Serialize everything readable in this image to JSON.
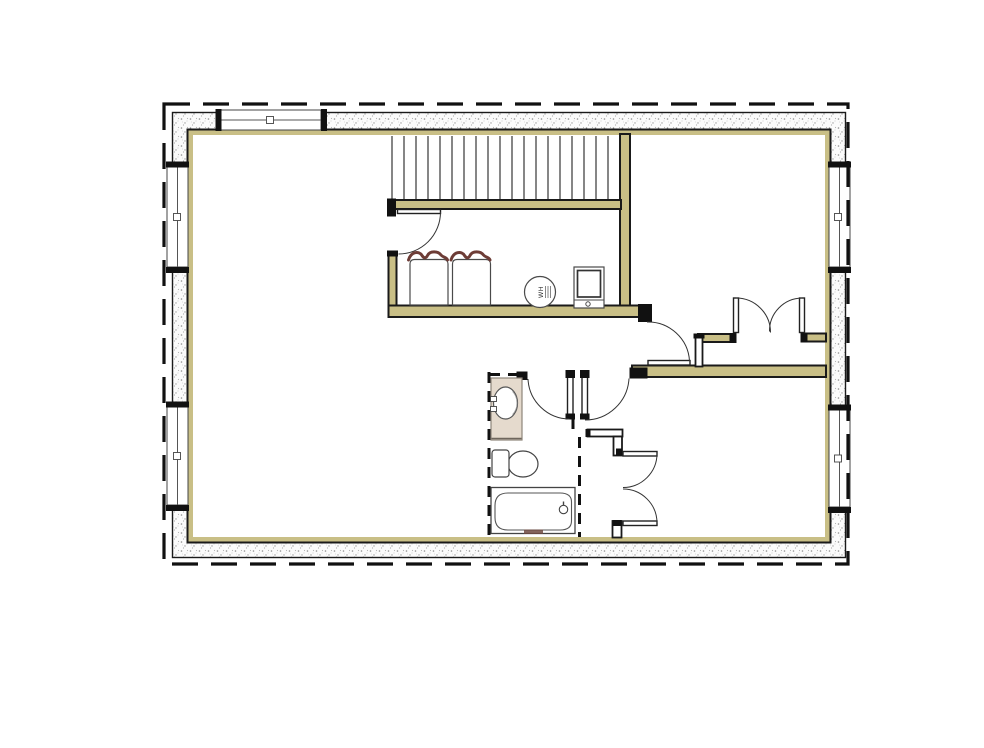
{
  "labels": {
    "water_heater": "WH"
  },
  "colors": {
    "paper": "#ffffff",
    "wall_fill": "#c9bf86",
    "line": "#1a1a1a",
    "stipple_dot": "#8f8f8f",
    "appliance_accent": "#6d3c36",
    "vanity_fill": "#e5dacd"
  },
  "plan": {
    "stairs": {
      "tread_count": 19
    },
    "fixtures": [
      {
        "name": "washer"
      },
      {
        "name": "dryer"
      },
      {
        "name": "water-heater",
        "label": "WH"
      },
      {
        "name": "furnace"
      },
      {
        "name": "vanity-sink"
      },
      {
        "name": "toilet"
      },
      {
        "name": "bathtub"
      }
    ],
    "doors": [
      "utility-room-door",
      "bathroom-door",
      "bedroom-door",
      "hall-door",
      "french-double-doors",
      "closet-double-doors"
    ],
    "windows": [
      "top-wall-window",
      "left-wall-upper-window",
      "left-wall-lower-window",
      "right-wall-upper-window",
      "right-wall-lower-window"
    ]
  }
}
